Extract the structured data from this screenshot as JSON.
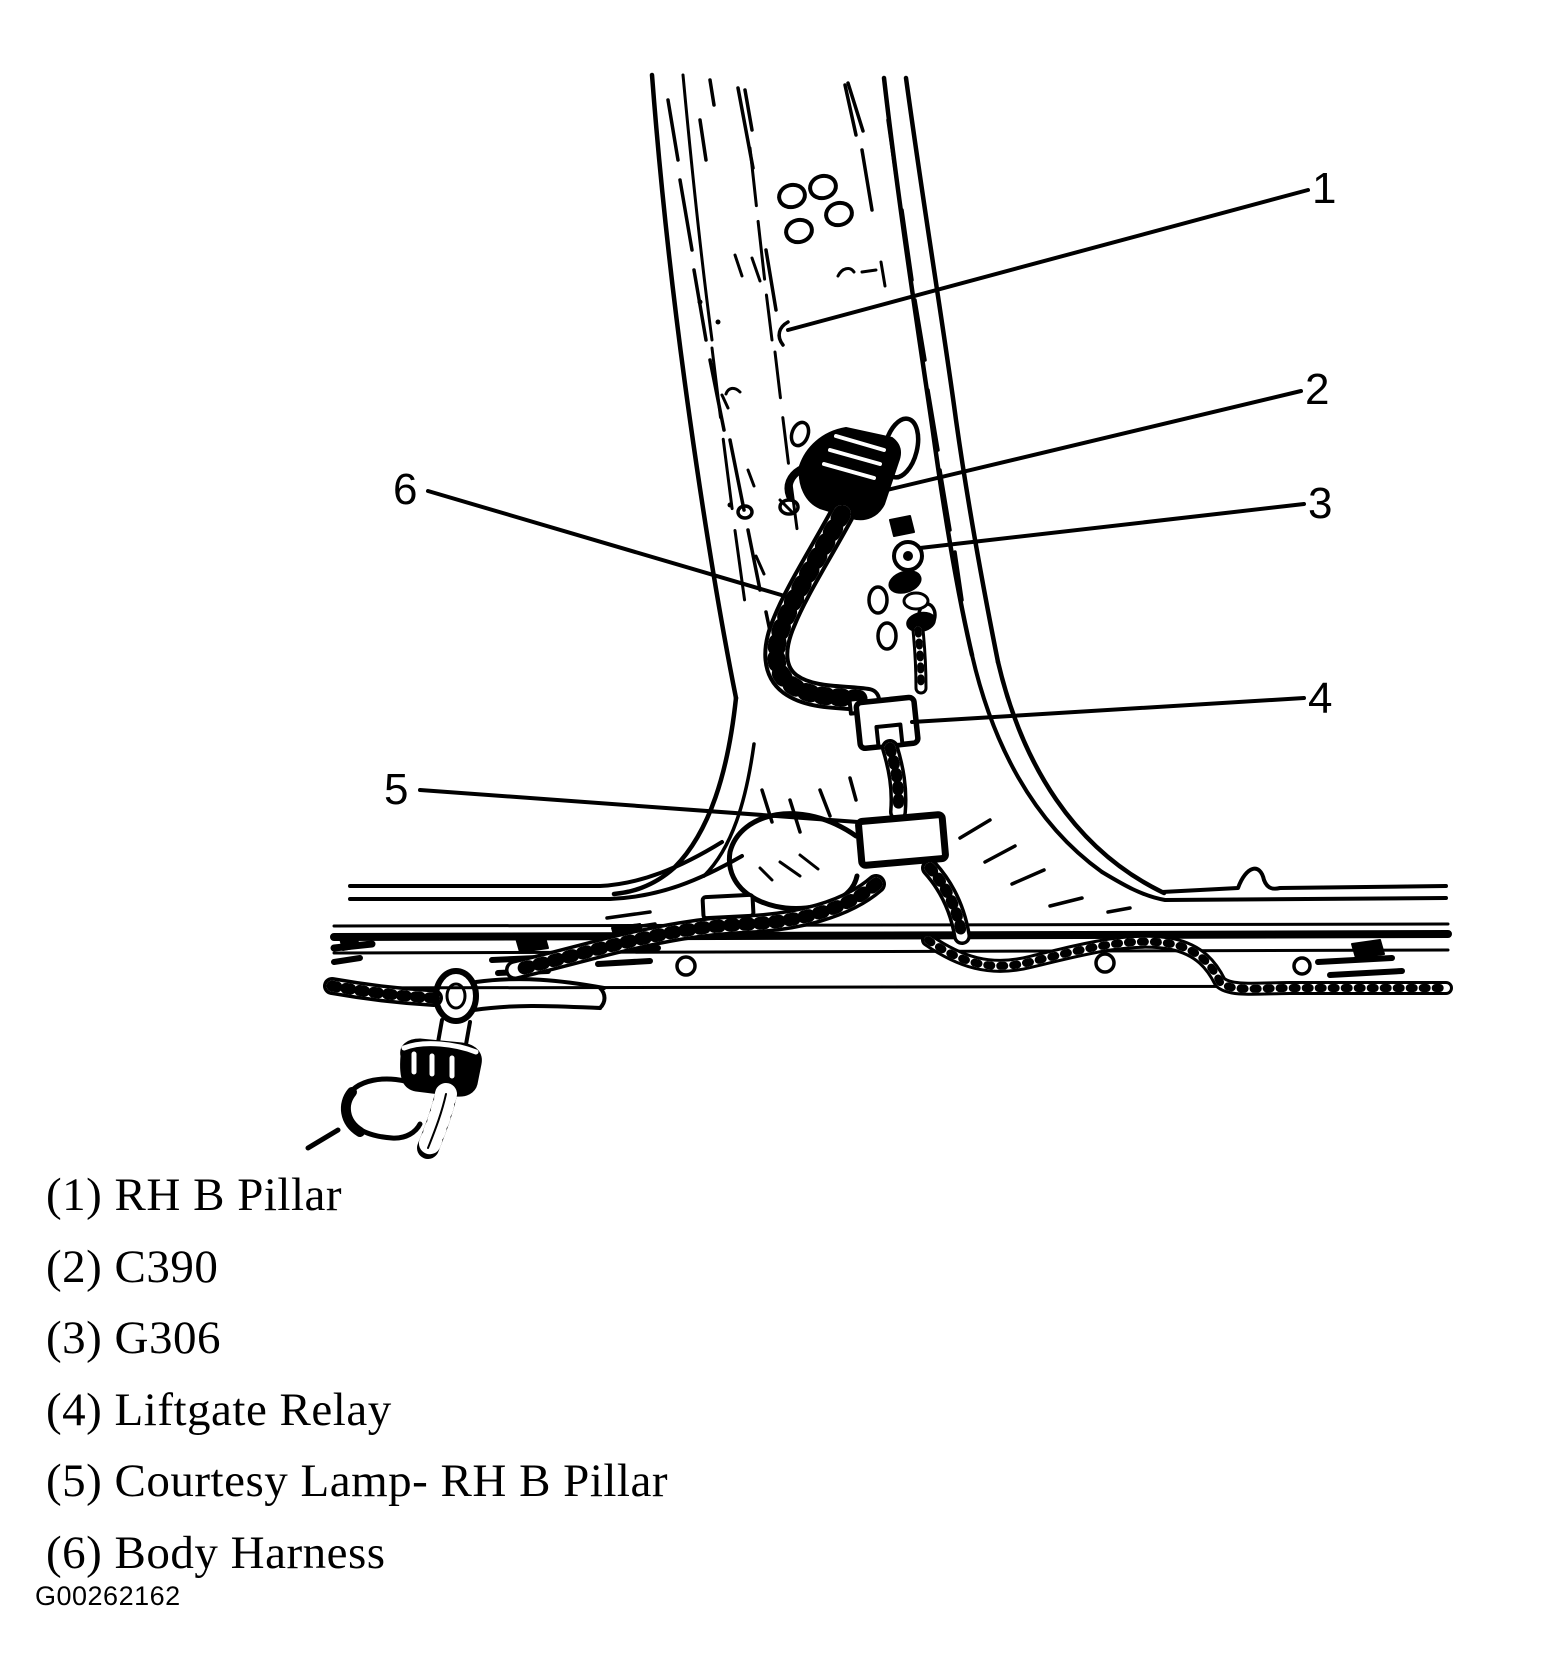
{
  "figure": {
    "code": "G00262162",
    "background_color": "#ffffff",
    "ink_color": "#000000",
    "description": "Line-art service diagram of RH B pillar wiring (liftgate relay / courtesy lamp area)"
  },
  "callouts": [
    {
      "number": "1",
      "label": "RH B Pillar"
    },
    {
      "number": "2",
      "label": "C390"
    },
    {
      "number": "3",
      "label": "G306"
    },
    {
      "number": "4",
      "label": "Liftgate Relay"
    },
    {
      "number": "5",
      "label": "Courtesy Lamp- RH B Pillar"
    },
    {
      "number": "6",
      "label": "Body Harness"
    }
  ],
  "legend": {
    "items": [
      {
        "number": "1",
        "label": "RH B Pillar",
        "display": "(1) RH B Pillar"
      },
      {
        "number": "2",
        "label": "C390",
        "display": "(2) C390"
      },
      {
        "number": "3",
        "label": "G306",
        "display": "(3) G306"
      },
      {
        "number": "4",
        "label": "Liftgate Relay",
        "display": "(4) Liftgate Relay"
      },
      {
        "number": "5",
        "label": "Courtesy Lamp- RH B Pillar",
        "display": "(5) Courtesy Lamp- RH B Pillar"
      },
      {
        "number": "6",
        "label": "Body Harness",
        "display": "(6) Body Harness"
      }
    ]
  }
}
